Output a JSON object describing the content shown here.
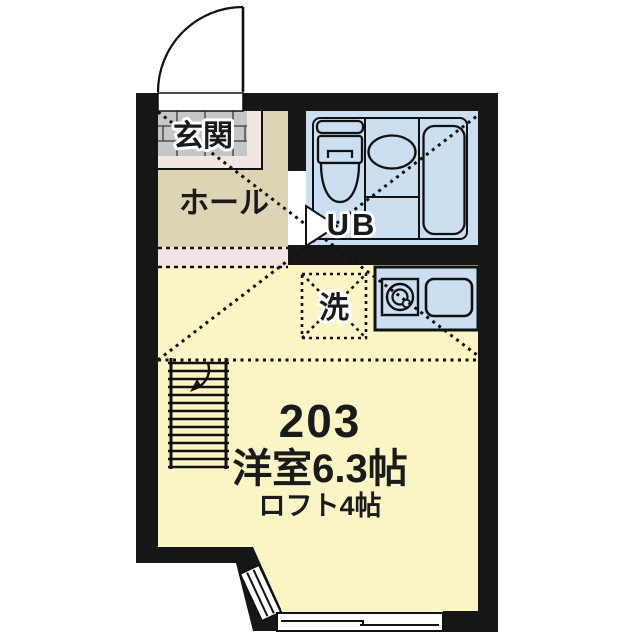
{
  "plan": {
    "unit_number": "203",
    "room_size_label": "洋室6.3帖",
    "loft_size_label": "ロフト4帖",
    "labels": {
      "entrance": "玄関",
      "hall": "ホール",
      "unit_bath": "UB",
      "washer": "洗"
    },
    "colors": {
      "background": "#ffffff",
      "wall": "#161616",
      "room_yellow": "#fbf5c6",
      "hall_tan": "#dcd4b4",
      "entrance_gray": "#c6c6c6",
      "entrance_pink": "#f2e6e0",
      "step_pink": "#f2e4e4",
      "bath_blue": "#cbdff1",
      "line": "#1a1a1a"
    }
  }
}
